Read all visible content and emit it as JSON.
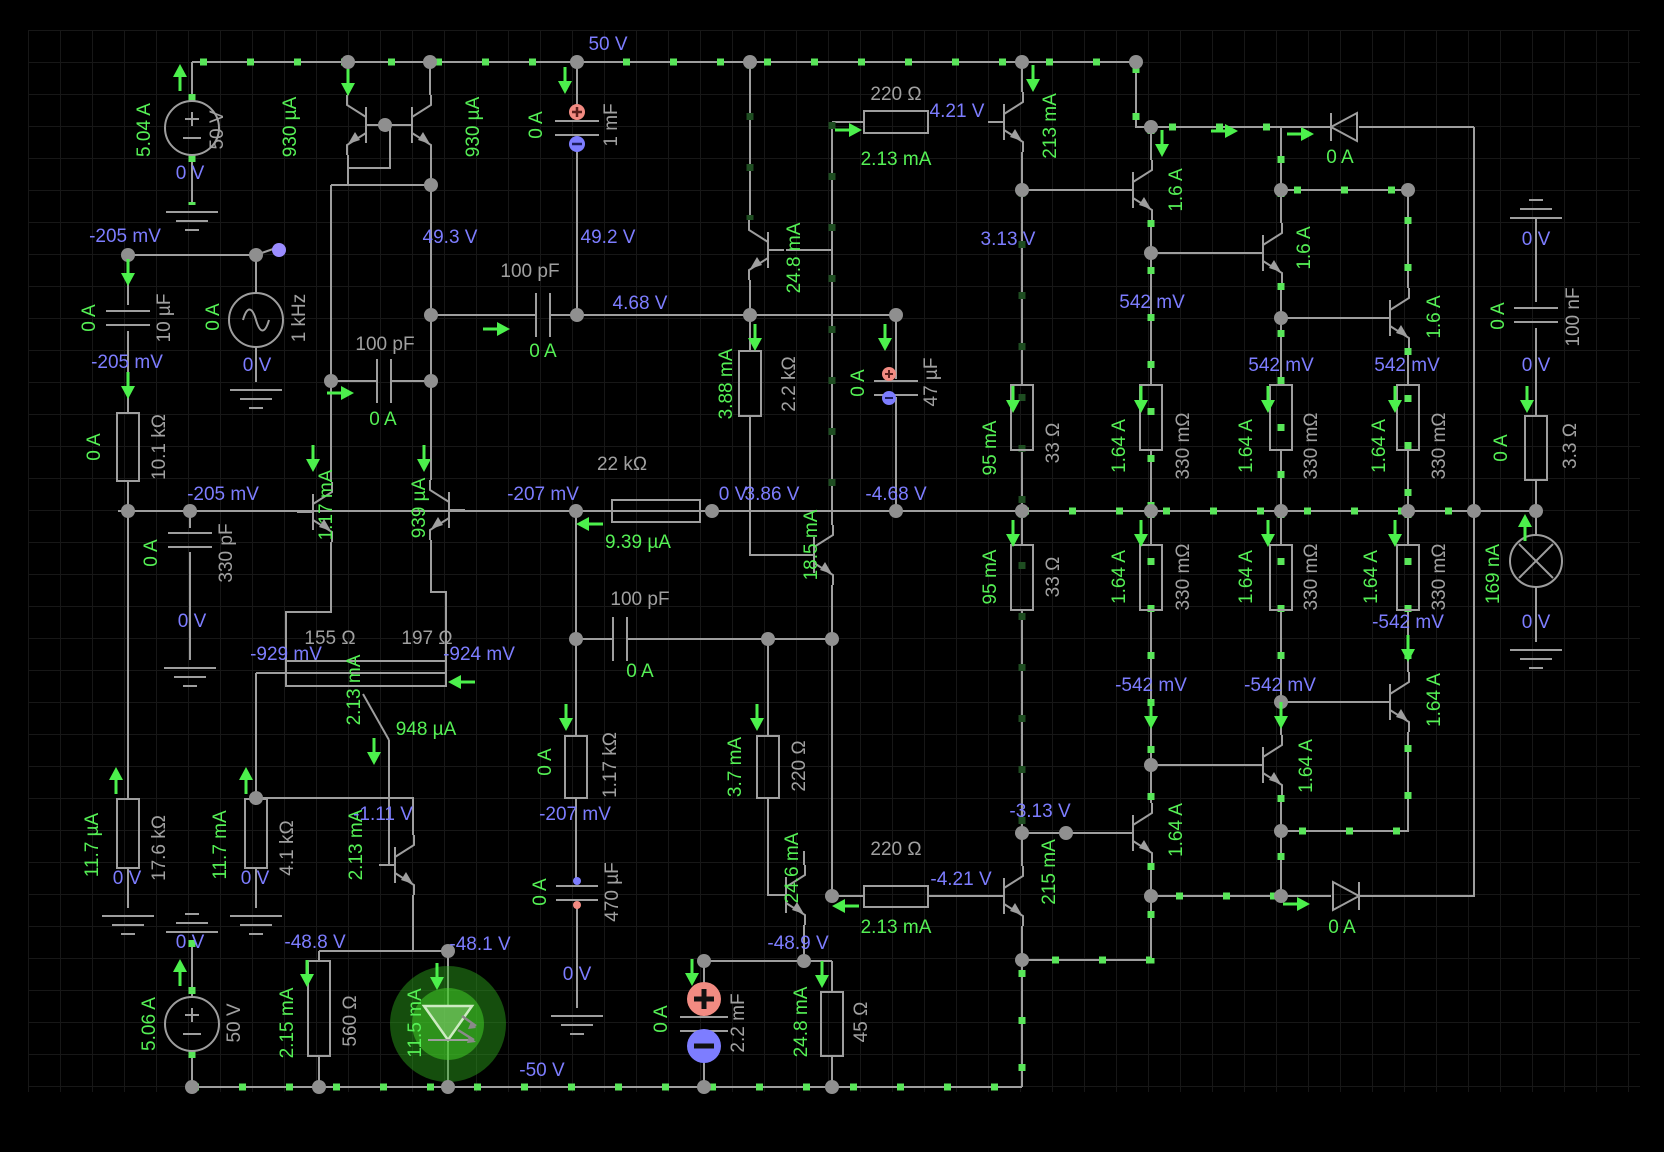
{
  "app": {
    "type": "circuit-simulation-canvas"
  },
  "colors": {
    "background": "#000000",
    "grid": "#171717",
    "wire": "#9e9e9e",
    "current_label": "#55f055",
    "voltage_label": "#7d7dff",
    "component_label": "#a0a0a0",
    "current_dots": "#59e659",
    "positive_terminal": "#f28b82",
    "negative_terminal": "#7d7dff",
    "led_glow": "#3ecc22"
  },
  "labels": [
    {
      "t": "5.04 A",
      "x": 145,
      "y": 130,
      "c": "g",
      "r": 1
    },
    {
      "t": "930 µA",
      "x": 291,
      "y": 127,
      "c": "g",
      "r": 1
    },
    {
      "t": "930 µA",
      "x": 474,
      "y": 127,
      "c": "g",
      "r": 1
    },
    {
      "t": "0 A",
      "x": 537,
      "y": 125,
      "c": "g",
      "r": 1
    },
    {
      "t": "2.13 mA",
      "x": 896,
      "y": 160,
      "c": "g",
      "r": 0
    },
    {
      "t": "213 mA",
      "x": 1051,
      "y": 126,
      "c": "g",
      "r": 1
    },
    {
      "t": "1.6 A",
      "x": 1177,
      "y": 190,
      "c": "g",
      "r": 1
    },
    {
      "t": "1.6 A",
      "x": 1305,
      "y": 248,
      "c": "g",
      "r": 1
    },
    {
      "t": "1.6 A",
      "x": 1435,
      "y": 317,
      "c": "g",
      "r": 1
    },
    {
      "t": "0 A",
      "x": 1340,
      "y": 158,
      "c": "g",
      "r": 0
    },
    {
      "t": "0 A",
      "x": 90,
      "y": 318,
      "c": "g",
      "r": 1
    },
    {
      "t": "0 A",
      "x": 214,
      "y": 317,
      "c": "g",
      "r": 1
    },
    {
      "t": "0 A",
      "x": 1499,
      "y": 316,
      "c": "g",
      "r": 1
    },
    {
      "t": "0 A",
      "x": 95,
      "y": 447,
      "c": "g",
      "r": 1
    },
    {
      "t": "0 A",
      "x": 383,
      "y": 420,
      "c": "g",
      "r": 0
    },
    {
      "t": "0 A",
      "x": 543,
      "y": 352,
      "c": "g",
      "r": 0
    },
    {
      "t": "1.17 mA",
      "x": 327,
      "y": 505,
      "c": "g",
      "r": 1
    },
    {
      "t": "939 µA",
      "x": 420,
      "y": 508,
      "c": "g",
      "r": 1
    },
    {
      "t": "9.39 µA",
      "x": 638,
      "y": 543,
      "c": "g",
      "r": 0
    },
    {
      "t": "3.88 mA",
      "x": 727,
      "y": 384,
      "c": "g",
      "r": 1
    },
    {
      "t": "0 A",
      "x": 859,
      "y": 383,
      "c": "g",
      "r": 1
    },
    {
      "t": "95 mA",
      "x": 991,
      "y": 448,
      "c": "g",
      "r": 1
    },
    {
      "t": "1.64 A",
      "x": 1120,
      "y": 446,
      "c": "g",
      "r": 1
    },
    {
      "t": "1.64 A",
      "x": 1247,
      "y": 446,
      "c": "g",
      "r": 1
    },
    {
      "t": "1.64 A",
      "x": 1380,
      "y": 446,
      "c": "g",
      "r": 1
    },
    {
      "t": "0 A",
      "x": 1502,
      "y": 448,
      "c": "g",
      "r": 1
    },
    {
      "t": "0 A",
      "x": 152,
      "y": 553,
      "c": "g",
      "r": 1
    },
    {
      "t": "18.5 mA",
      "x": 812,
      "y": 545,
      "c": "g",
      "r": 1
    },
    {
      "t": "95 mA",
      "x": 991,
      "y": 577,
      "c": "g",
      "r": 1
    },
    {
      "t": "1.64 A",
      "x": 1120,
      "y": 577,
      "c": "g",
      "r": 1
    },
    {
      "t": "1.64 A",
      "x": 1247,
      "y": 577,
      "c": "g",
      "r": 1
    },
    {
      "t": "1.64 A",
      "x": 1372,
      "y": 577,
      "c": "g",
      "r": 1
    },
    {
      "t": "1.64 A",
      "x": 1435,
      "y": 700,
      "c": "g",
      "r": 1
    },
    {
      "t": "1.64 A",
      "x": 1307,
      "y": 766,
      "c": "g",
      "r": 1
    },
    {
      "t": "1.64 A",
      "x": 1177,
      "y": 830,
      "c": "g",
      "r": 1
    },
    {
      "t": "215 mA",
      "x": 1050,
      "y": 872,
      "c": "g",
      "r": 1
    },
    {
      "t": "169 nA",
      "x": 1494,
      "y": 574,
      "c": "g",
      "r": 1
    },
    {
      "t": "11.7 µA",
      "x": 93,
      "y": 845,
      "c": "g",
      "r": 1
    },
    {
      "t": "11.7 mA",
      "x": 221,
      "y": 845,
      "c": "g",
      "r": 1
    },
    {
      "t": "2.13 mA",
      "x": 355,
      "y": 690,
      "c": "g",
      "r": 1
    },
    {
      "t": "948 µA",
      "x": 426,
      "y": 730,
      "c": "g",
      "r": 0
    },
    {
      "t": "2.13 mA",
      "x": 357,
      "y": 845,
      "c": "g",
      "r": 1
    },
    {
      "t": "2.15 mA",
      "x": 288,
      "y": 1023,
      "c": "g",
      "r": 1
    },
    {
      "t": "11.5 mA",
      "x": 416,
      "y": 1023,
      "c": "g",
      "r": 1
    },
    {
      "t": "0 A",
      "x": 541,
      "y": 892,
      "c": "g",
      "r": 1
    },
    {
      "t": "0 A",
      "x": 546,
      "y": 762,
      "c": "g",
      "r": 1
    },
    {
      "t": "0 A",
      "x": 640,
      "y": 672,
      "c": "g",
      "r": 0
    },
    {
      "t": "3.7 mA",
      "x": 736,
      "y": 767,
      "c": "g",
      "r": 1
    },
    {
      "t": "24.8 mA",
      "x": 795,
      "y": 258,
      "c": "g",
      "r": 1
    },
    {
      "t": "24.6 mA",
      "x": 793,
      "y": 868,
      "c": "g",
      "r": 1
    },
    {
      "t": "24.8 mA",
      "x": 802,
      "y": 1022,
      "c": "g",
      "r": 1
    },
    {
      "t": "0 A",
      "x": 662,
      "y": 1019,
      "c": "g",
      "r": 1
    },
    {
      "t": "2.13 mA",
      "x": 896,
      "y": 928,
      "c": "g",
      "r": 0
    },
    {
      "t": "5.06 A",
      "x": 150,
      "y": 1024,
      "c": "g",
      "r": 1
    },
    {
      "t": "0 A",
      "x": 1342,
      "y": 928,
      "c": "g",
      "r": 0
    },
    {
      "t": "50 V",
      "x": 608,
      "y": 45,
      "c": "b",
      "r": 0
    },
    {
      "t": "0 V",
      "x": 190,
      "y": 174,
      "c": "b",
      "r": 0
    },
    {
      "t": "-205 mV",
      "x": 125,
      "y": 237,
      "c": "b",
      "r": 0
    },
    {
      "t": "49.3 V",
      "x": 450,
      "y": 238,
      "c": "b",
      "r": 0
    },
    {
      "t": "49.2 V",
      "x": 608,
      "y": 238,
      "c": "b",
      "r": 0
    },
    {
      "t": "4.21 V",
      "x": 957,
      "y": 112,
      "c": "b",
      "r": 0
    },
    {
      "t": "3.13 V",
      "x": 1008,
      "y": 240,
      "c": "b",
      "r": 0
    },
    {
      "t": "-205 mV",
      "x": 127,
      "y": 363,
      "c": "b",
      "r": 0
    },
    {
      "t": "0 V",
      "x": 257,
      "y": 366,
      "c": "b",
      "r": 0
    },
    {
      "t": "4.68 V",
      "x": 640,
      "y": 304,
      "c": "b",
      "r": 0
    },
    {
      "t": "542 mV",
      "x": 1152,
      "y": 303,
      "c": "b",
      "r": 0
    },
    {
      "t": "542 mV",
      "x": 1281,
      "y": 366,
      "c": "b",
      "r": 0
    },
    {
      "t": "542 mV",
      "x": 1407,
      "y": 366,
      "c": "b",
      "r": 0
    },
    {
      "t": "0 V",
      "x": 1536,
      "y": 240,
      "c": "b",
      "r": 0
    },
    {
      "t": "0 V",
      "x": 1536,
      "y": 366,
      "c": "b",
      "r": 0
    },
    {
      "t": "-205 mV",
      "x": 223,
      "y": 495,
      "c": "b",
      "r": 0
    },
    {
      "t": "-207 mV",
      "x": 543,
      "y": 495,
      "c": "b",
      "r": 0
    },
    {
      "t": "0 V",
      "x": 733,
      "y": 495,
      "c": "b",
      "r": 0
    },
    {
      "t": "3.86 V",
      "x": 772,
      "y": 495,
      "c": "b",
      "r": 0
    },
    {
      "t": "-4.68 V",
      "x": 896,
      "y": 495,
      "c": "b",
      "r": 0
    },
    {
      "t": "0 V",
      "x": 192,
      "y": 622,
      "c": "b",
      "r": 0
    },
    {
      "t": "-929 mV",
      "x": 286,
      "y": 655,
      "c": "b",
      "r": 0
    },
    {
      "t": "-924 mV",
      "x": 479,
      "y": 655,
      "c": "b",
      "r": 0
    },
    {
      "t": "-542 mV",
      "x": 1408,
      "y": 623,
      "c": "b",
      "r": 0
    },
    {
      "t": "-542 mV",
      "x": 1151,
      "y": 686,
      "c": "b",
      "r": 0
    },
    {
      "t": "-542 mV",
      "x": 1280,
      "y": 686,
      "c": "b",
      "r": 0
    },
    {
      "t": "0 V",
      "x": 1536,
      "y": 623,
      "c": "b",
      "r": 0
    },
    {
      "t": "-3.13 V",
      "x": 1040,
      "y": 812,
      "c": "b",
      "r": 0
    },
    {
      "t": "-1.11 V",
      "x": 383,
      "y": 815,
      "c": "b",
      "r": 0
    },
    {
      "t": "-207 mV",
      "x": 575,
      "y": 815,
      "c": "b",
      "r": 0
    },
    {
      "t": "0 V",
      "x": 127,
      "y": 879,
      "c": "b",
      "r": 0
    },
    {
      "t": "0 V",
      "x": 255,
      "y": 879,
      "c": "b",
      "r": 0
    },
    {
      "t": "0 V",
      "x": 190,
      "y": 943,
      "c": "b",
      "r": 0
    },
    {
      "t": "-48.8 V",
      "x": 315,
      "y": 943,
      "c": "b",
      "r": 0
    },
    {
      "t": "-48.1 V",
      "x": 480,
      "y": 945,
      "c": "b",
      "r": 0
    },
    {
      "t": "-48.9 V",
      "x": 798,
      "y": 944,
      "c": "b",
      "r": 0
    },
    {
      "t": "-4.21 V",
      "x": 961,
      "y": 880,
      "c": "b",
      "r": 0
    },
    {
      "t": "0 V",
      "x": 577,
      "y": 975,
      "c": "b",
      "r": 0
    },
    {
      "t": "-50 V",
      "x": 542,
      "y": 1071,
      "c": "b",
      "r": 0
    },
    {
      "t": "50 V",
      "x": 218,
      "y": 130,
      "c": "u",
      "r": 1
    },
    {
      "t": "1 mF",
      "x": 612,
      "y": 125,
      "c": "u",
      "r": 1
    },
    {
      "t": "220 Ω",
      "x": 896,
      "y": 95,
      "c": "u",
      "r": 0
    },
    {
      "t": "10 µF",
      "x": 165,
      "y": 318,
      "c": "u",
      "r": 1
    },
    {
      "t": "1 kHz",
      "x": 300,
      "y": 318,
      "c": "u",
      "r": 1
    },
    {
      "t": "100 nF",
      "x": 1574,
      "y": 317,
      "c": "u",
      "r": 1
    },
    {
      "t": "10.1 kΩ",
      "x": 160,
      "y": 447,
      "c": "u",
      "r": 1
    },
    {
      "t": "100 pF",
      "x": 385,
      "y": 345,
      "c": "u",
      "r": 0
    },
    {
      "t": "100 pF",
      "x": 530,
      "y": 272,
      "c": "u",
      "r": 0
    },
    {
      "t": "22 kΩ",
      "x": 622,
      "y": 465,
      "c": "u",
      "r": 0
    },
    {
      "t": "2.2 kΩ",
      "x": 790,
      "y": 384,
      "c": "u",
      "r": 1
    },
    {
      "t": "47 µF",
      "x": 932,
      "y": 382,
      "c": "u",
      "r": 1
    },
    {
      "t": "33 Ω",
      "x": 1054,
      "y": 443,
      "c": "u",
      "r": 1
    },
    {
      "t": "330 mΩ",
      "x": 1184,
      "y": 446,
      "c": "u",
      "r": 1
    },
    {
      "t": "330 mΩ",
      "x": 1312,
      "y": 446,
      "c": "u",
      "r": 1
    },
    {
      "t": "330 mΩ",
      "x": 1440,
      "y": 446,
      "c": "u",
      "r": 1
    },
    {
      "t": "3.3 Ω",
      "x": 1571,
      "y": 446,
      "c": "u",
      "r": 1
    },
    {
      "t": "33 Ω",
      "x": 1054,
      "y": 577,
      "c": "u",
      "r": 1
    },
    {
      "t": "330 mΩ",
      "x": 1184,
      "y": 577,
      "c": "u",
      "r": 1
    },
    {
      "t": "330 mΩ",
      "x": 1312,
      "y": 577,
      "c": "u",
      "r": 1
    },
    {
      "t": "330 mΩ",
      "x": 1440,
      "y": 577,
      "c": "u",
      "r": 1
    },
    {
      "t": "330 pF",
      "x": 227,
      "y": 553,
      "c": "u",
      "r": 1
    },
    {
      "t": "155 Ω",
      "x": 330,
      "y": 639,
      "c": "u",
      "r": 0
    },
    {
      "t": "197 Ω",
      "x": 427,
      "y": 639,
      "c": "u",
      "r": 0
    },
    {
      "t": "100 pF",
      "x": 640,
      "y": 600,
      "c": "u",
      "r": 0
    },
    {
      "t": "1.17 kΩ",
      "x": 611,
      "y": 765,
      "c": "u",
      "r": 1
    },
    {
      "t": "220 Ω",
      "x": 800,
      "y": 766,
      "c": "u",
      "r": 1
    },
    {
      "t": "220 Ω",
      "x": 896,
      "y": 850,
      "c": "u",
      "r": 0
    },
    {
      "t": "17.6 kΩ",
      "x": 160,
      "y": 848,
      "c": "u",
      "r": 1
    },
    {
      "t": "4.1 kΩ",
      "x": 288,
      "y": 848,
      "c": "u",
      "r": 1
    },
    {
      "t": "560 Ω",
      "x": 351,
      "y": 1021,
      "c": "u",
      "r": 1
    },
    {
      "t": "470 µF",
      "x": 613,
      "y": 892,
      "c": "u",
      "r": 1
    },
    {
      "t": "2.2 mF",
      "x": 739,
      "y": 1023,
      "c": "u",
      "r": 1
    },
    {
      "t": "45 Ω",
      "x": 862,
      "y": 1022,
      "c": "u",
      "r": 1
    },
    {
      "t": "50 V",
      "x": 235,
      "y": 1023,
      "c": "u",
      "r": 1
    }
  ]
}
